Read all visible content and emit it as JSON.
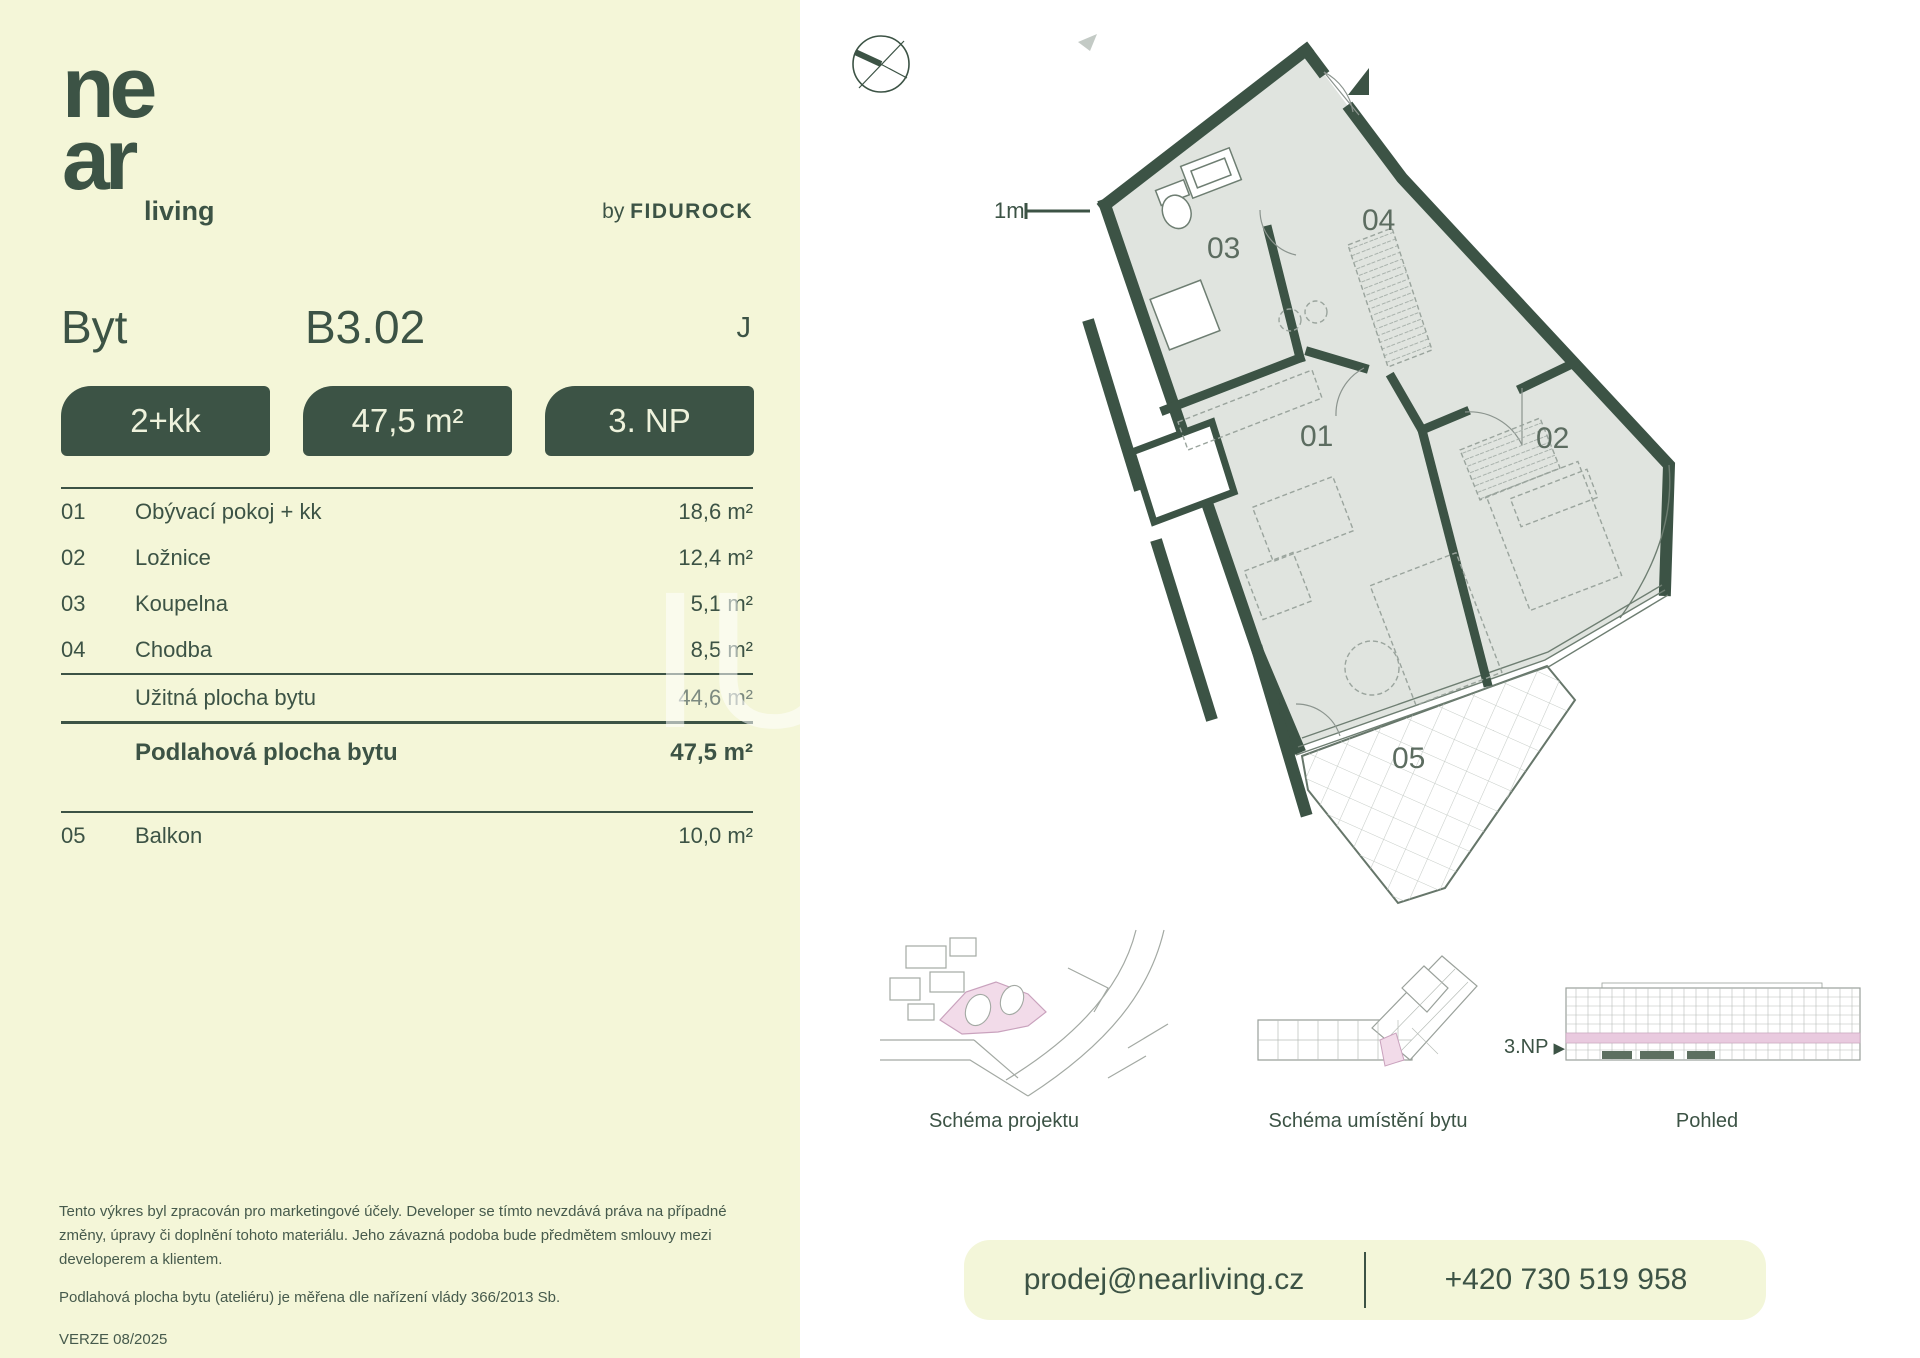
{
  "brand": {
    "logo_line1": "ne",
    "logo_line2": "ar",
    "logo_suffix": "living",
    "byline_prefix": "by",
    "byline_brand": "FIDUROCK"
  },
  "header": {
    "unit_label": "Byt",
    "unit_number": "B3.02",
    "layout_letter": "J"
  },
  "badges": [
    {
      "label": "2+kk"
    },
    {
      "label": "47,5 m²"
    },
    {
      "label": "3. NP"
    }
  ],
  "rooms": [
    {
      "num": "01",
      "name": "Obývací pokoj + kk",
      "area": "18,6 m²"
    },
    {
      "num": "02",
      "name": "Ložnice",
      "area": "12,4 m²"
    },
    {
      "num": "03",
      "name": "Koupelna",
      "area": "5,1 m²"
    },
    {
      "num": "04",
      "name": "Chodba",
      "area": "8,5 m²"
    }
  ],
  "totals": {
    "usable": {
      "name": "Užitná plocha bytu",
      "area": "44,6 m²"
    },
    "floor": {
      "name": "Podlahová plocha bytu",
      "area": "47,5 m²"
    }
  },
  "extra_room": {
    "num": "05",
    "name": "Balkon",
    "area": "10,0 m²"
  },
  "plan": {
    "scale_label": "1m",
    "labels": {
      "r01": "01",
      "r02": "02",
      "r03": "03",
      "r04": "04",
      "r05": "05"
    }
  },
  "schematics": [
    {
      "caption": "Schéma projektu"
    },
    {
      "caption": "Schéma umístění bytu"
    },
    {
      "caption": "Pohled"
    }
  ],
  "floor_indicator": {
    "label": "3.NP",
    "arrow": "▶"
  },
  "footer": {
    "disclaimer1": "Tento výkres byl zpracován pro marketingové účely. Developer se tímto nevzdává práva na případné změny, úpravy či doplnění tohoto materiálu. Jeho závazná podoba bude předmětem smlouvy mezi developerem a klientem.",
    "disclaimer2": "Podlahová plocha bytu (ateliéru) je měřena dle nařízení vlády 366/2013 Sb.",
    "version": "VERZE 08/2025"
  },
  "contact": {
    "email": "prodej@nearliving.cz",
    "phone": "+420 730 519 958"
  },
  "colors": {
    "green": "#3c5345",
    "cream": "#f4f6d8",
    "plan_fill": "#e0e4df",
    "pink": "#f1d9e8"
  }
}
